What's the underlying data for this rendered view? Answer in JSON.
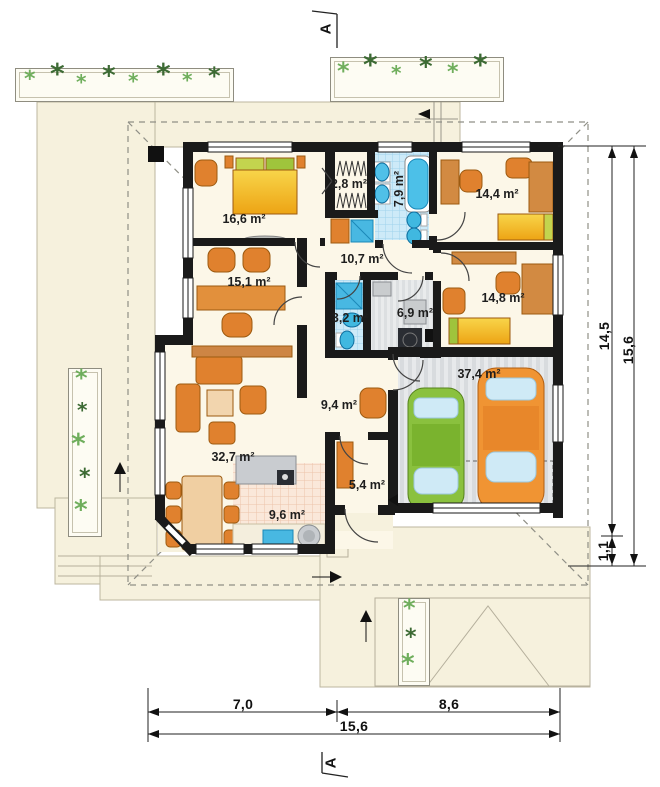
{
  "plan": {
    "section_marker": "A",
    "rooms": [
      {
        "name": "bedroom",
        "area": "16,6 m²"
      },
      {
        "name": "wardrobe",
        "area": "2,8 m²"
      },
      {
        "name": "bathroom",
        "area": "7,9 m²"
      },
      {
        "name": "child-room",
        "area": "14,4 m²"
      },
      {
        "name": "hall-upper",
        "area": "10,7 m²"
      },
      {
        "name": "study",
        "area": "15,1 m²"
      },
      {
        "name": "wc",
        "area": "3,2 m²"
      },
      {
        "name": "utility",
        "area": "6,9 m²"
      },
      {
        "name": "bedroom-2",
        "area": "14,8 m²"
      },
      {
        "name": "hall-lower",
        "area": "9,4 m²"
      },
      {
        "name": "garage",
        "area": "37,4 m²"
      },
      {
        "name": "living-room",
        "area": "32,7 m²"
      },
      {
        "name": "entry",
        "area": "5,4 m²"
      },
      {
        "name": "kitchen",
        "area": "9,6 m²"
      }
    ],
    "dimensions": {
      "right": [
        {
          "name": "house-depth",
          "label": "14,5"
        },
        {
          "name": "total-depth",
          "label": "15,6"
        },
        {
          "name": "eave-depth",
          "label": "1,1"
        }
      ],
      "bottom": [
        {
          "name": "left-width",
          "label": "7,0"
        },
        {
          "name": "right-width",
          "label": "8,6"
        },
        {
          "name": "total-width",
          "label": "15,6"
        }
      ]
    },
    "icons": {
      "plant_glyph": "*"
    },
    "colors": {
      "ground": "#f6f1dd",
      "wall": "#1a1a1a",
      "tile_blue": "#cdeaf8",
      "tile_pink": "#fae8da",
      "furniture_orange": "#e0812e",
      "bed_yellow": "#f2bb24",
      "car_green": "#8ac13e",
      "car_orange": "#f09433",
      "plant_green": "#6fae5c"
    }
  }
}
